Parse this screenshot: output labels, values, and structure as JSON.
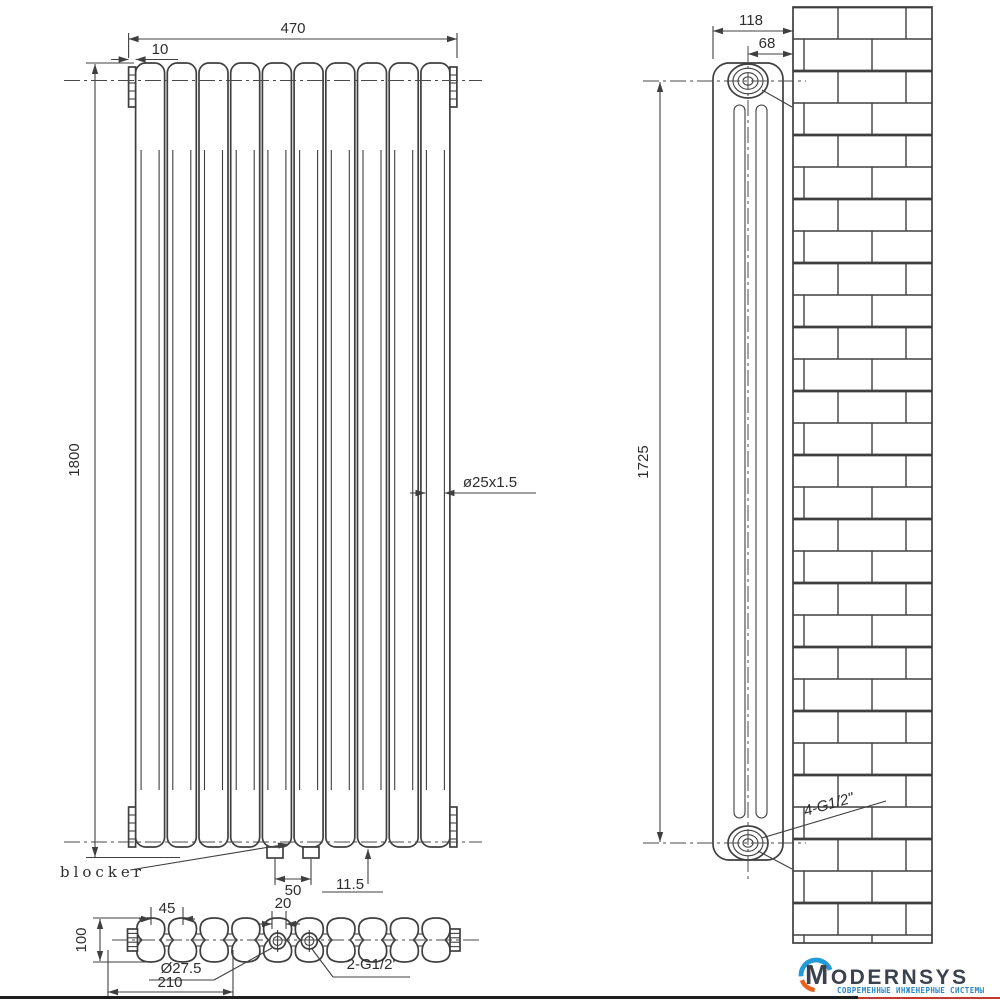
{
  "drawing": {
    "front_view": {
      "label_blocker": "blocker",
      "dim_total_width": "470",
      "dim_end_offset": "10",
      "dim_height": "1800",
      "dim_tube": "ø25x1.5",
      "dim_bracket_spacing": "50",
      "dim_bracket_width": "11.5"
    },
    "side_view": {
      "dim_depth": "118",
      "dim_center_to_wall": "68",
      "dim_connection_height": "1725",
      "label_connections": "4-G1/2\""
    },
    "top_view": {
      "dim_section_pitch": "45",
      "dim_port_gap": "20",
      "dim_depth": "100",
      "dim_port_diameter": "Ø27.5",
      "dim_port_distance": "210",
      "label_ports": "2-G1/2'"
    },
    "sections_count": "10"
  },
  "logo": {
    "brand": "MODERNSYS",
    "tagline": "СОВРЕМЕННЫЕ ИНЖЕНЕРНЫЕ СИСТЕМЫ"
  },
  "colors": {
    "line": "#3f3f3f",
    "logo_blue": "#229bd8",
    "logo_orange": "#e8611f",
    "brand_text": "#3b424e",
    "tagline_blue": "#2a86c8",
    "underline_red": "#c23a2e"
  }
}
